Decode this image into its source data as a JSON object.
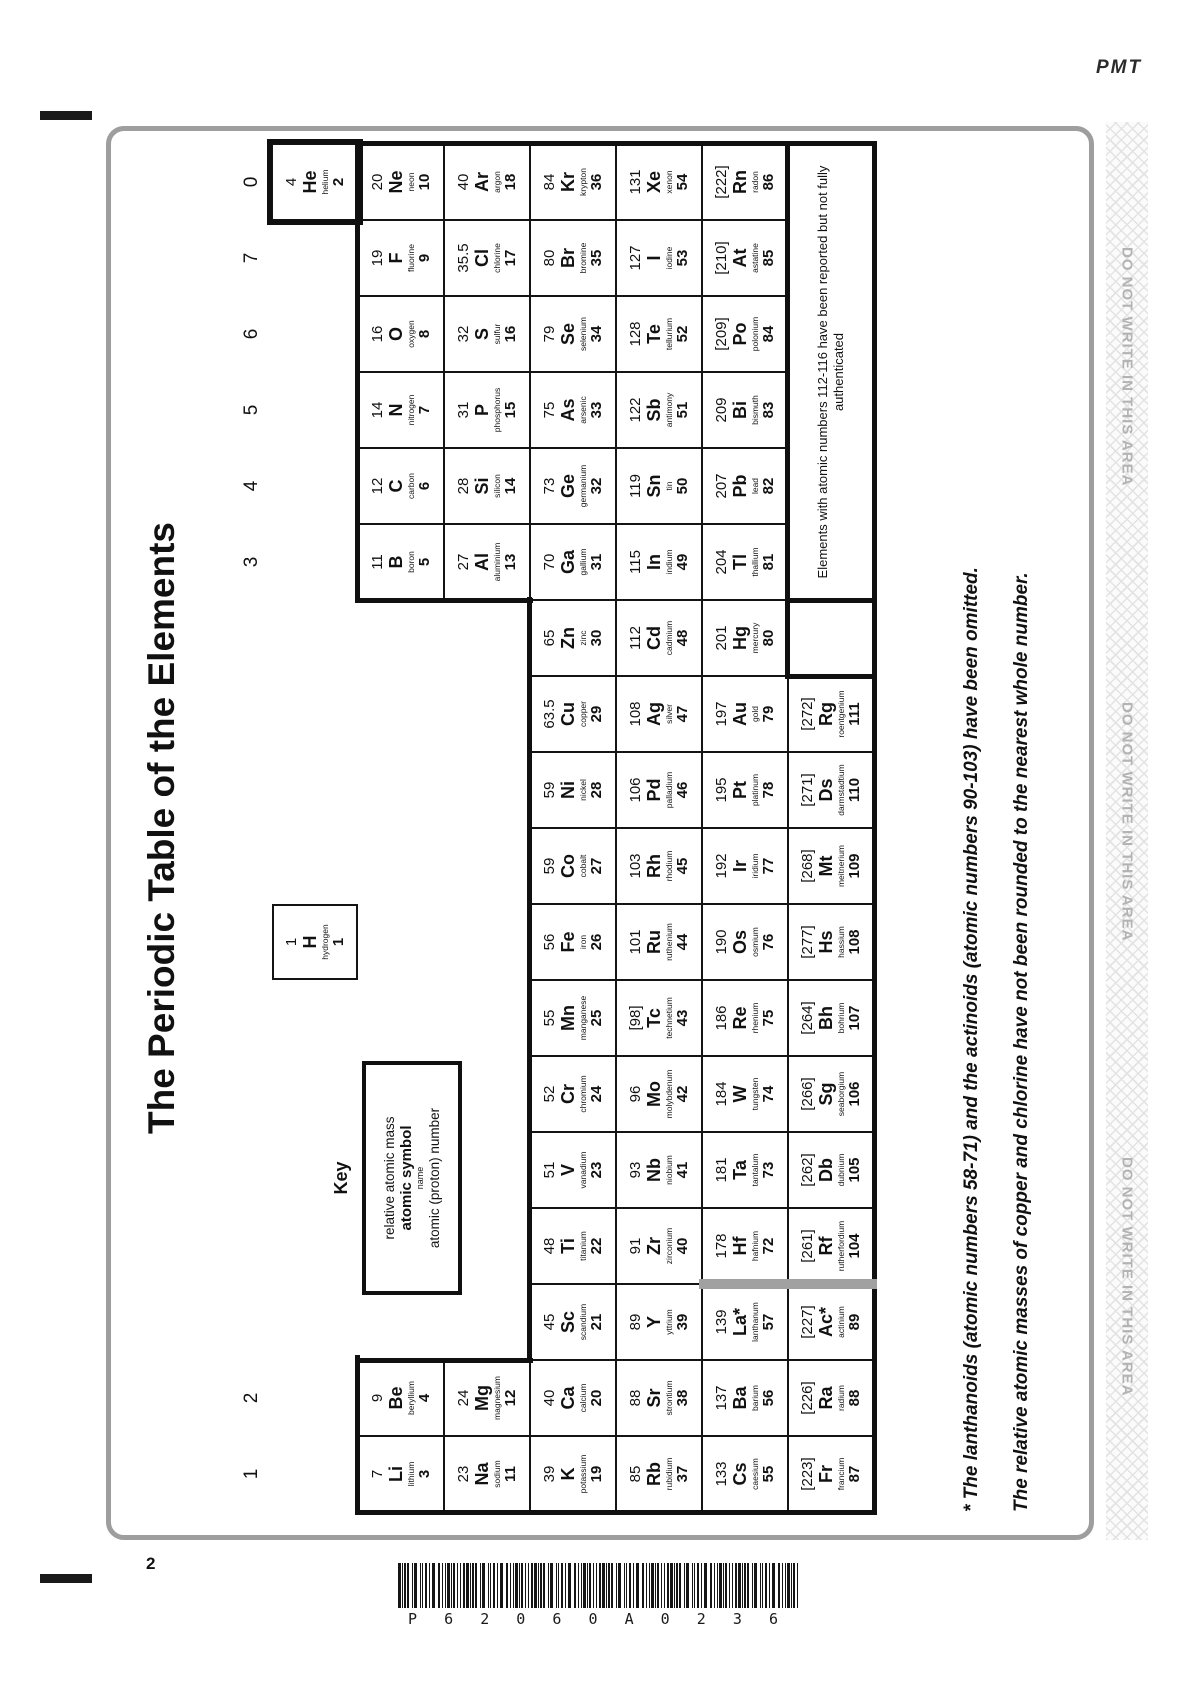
{
  "page": {
    "pmt": "PMT",
    "page_number": "2",
    "barcode_text": "P62060A0236"
  },
  "margin_strip": {
    "text": "DO NOT WRITE IN THIS AREA",
    "repeat": 3
  },
  "colors": {
    "frame_gray": "#9e9e9e",
    "strip_text_gray": "#b3b3b3",
    "divider_gray": "#a1a1a1",
    "ink": "#111111"
  },
  "table": {
    "title": "The Periodic Table of the Elements",
    "group_labels": [
      {
        "label": "1",
        "col": 1
      },
      {
        "label": "2",
        "col": 2
      },
      {
        "label": "3",
        "col": 13
      },
      {
        "label": "4",
        "col": 14
      },
      {
        "label": "5",
        "col": 15
      },
      {
        "label": "6",
        "col": 16
      },
      {
        "label": "7",
        "col": 17
      },
      {
        "label": "0",
        "col": 18
      }
    ],
    "key": {
      "heading": "Key",
      "mass": "relative atomic mass",
      "symbol": "atomic symbol",
      "name": "name",
      "number": "atomic (proton) number"
    },
    "note_lines": [
      "Elements with atomic numbers 112-116 have been reported but not fully",
      "authenticated"
    ],
    "footnotes": [
      "* The lanthanoids (atomic numbers 58-71) and the actinoids (atomic numbers 90-103) have been omitted.",
      "The relative atomic masses of copper and chlorine have not been rounded to the nearest whole number."
    ],
    "elements": [
      {
        "m": "1",
        "s": "H",
        "n": "hydrogen",
        "z": "1",
        "r": 1,
        "c": 8
      },
      {
        "m": "4",
        "s": "He",
        "n": "helium",
        "z": "2",
        "r": 1,
        "c": 18
      },
      {
        "m": "7",
        "s": "Li",
        "n": "lithium",
        "z": "3",
        "r": 2,
        "c": 1
      },
      {
        "m": "9",
        "s": "Be",
        "n": "beryllium",
        "z": "4",
        "r": 2,
        "c": 2
      },
      {
        "m": "11",
        "s": "B",
        "n": "boron",
        "z": "5",
        "r": 2,
        "c": 13
      },
      {
        "m": "12",
        "s": "C",
        "n": "carbon",
        "z": "6",
        "r": 2,
        "c": 14
      },
      {
        "m": "14",
        "s": "N",
        "n": "nitrogen",
        "z": "7",
        "r": 2,
        "c": 15
      },
      {
        "m": "16",
        "s": "O",
        "n": "oxygen",
        "z": "8",
        "r": 2,
        "c": 16
      },
      {
        "m": "19",
        "s": "F",
        "n": "fluorine",
        "z": "9",
        "r": 2,
        "c": 17
      },
      {
        "m": "20",
        "s": "Ne",
        "n": "neon",
        "z": "10",
        "r": 2,
        "c": 18
      },
      {
        "m": "23",
        "s": "Na",
        "n": "sodium",
        "z": "11",
        "r": 3,
        "c": 1
      },
      {
        "m": "24",
        "s": "Mg",
        "n": "magnesium",
        "z": "12",
        "r": 3,
        "c": 2
      },
      {
        "m": "27",
        "s": "Al",
        "n": "aluminium",
        "z": "13",
        "r": 3,
        "c": 13
      },
      {
        "m": "28",
        "s": "Si",
        "n": "silicon",
        "z": "14",
        "r": 3,
        "c": 14
      },
      {
        "m": "31",
        "s": "P",
        "n": "phosphorus",
        "z": "15",
        "r": 3,
        "c": 15
      },
      {
        "m": "32",
        "s": "S",
        "n": "sulfur",
        "z": "16",
        "r": 3,
        "c": 16
      },
      {
        "m": "35.5",
        "s": "Cl",
        "n": "chlorine",
        "z": "17",
        "r": 3,
        "c": 17
      },
      {
        "m": "40",
        "s": "Ar",
        "n": "argon",
        "z": "18",
        "r": 3,
        "c": 18
      },
      {
        "m": "39",
        "s": "K",
        "n": "potassium",
        "z": "19",
        "r": 4,
        "c": 1
      },
      {
        "m": "40",
        "s": "Ca",
        "n": "calcium",
        "z": "20",
        "r": 4,
        "c": 2
      },
      {
        "m": "45",
        "s": "Sc",
        "n": "scandium",
        "z": "21",
        "r": 4,
        "c": 3
      },
      {
        "m": "48",
        "s": "Ti",
        "n": "titanium",
        "z": "22",
        "r": 4,
        "c": 4
      },
      {
        "m": "51",
        "s": "V",
        "n": "vanadium",
        "z": "23",
        "r": 4,
        "c": 5
      },
      {
        "m": "52",
        "s": "Cr",
        "n": "chromium",
        "z": "24",
        "r": 4,
        "c": 6
      },
      {
        "m": "55",
        "s": "Mn",
        "n": "manganese",
        "z": "25",
        "r": 4,
        "c": 7
      },
      {
        "m": "56",
        "s": "Fe",
        "n": "iron",
        "z": "26",
        "r": 4,
        "c": 8
      },
      {
        "m": "59",
        "s": "Co",
        "n": "cobalt",
        "z": "27",
        "r": 4,
        "c": 9
      },
      {
        "m": "59",
        "s": "Ni",
        "n": "nickel",
        "z": "28",
        "r": 4,
        "c": 10
      },
      {
        "m": "63.5",
        "s": "Cu",
        "n": "copper",
        "z": "29",
        "r": 4,
        "c": 11
      },
      {
        "m": "65",
        "s": "Zn",
        "n": "zinc",
        "z": "30",
        "r": 4,
        "c": 12
      },
      {
        "m": "70",
        "s": "Ga",
        "n": "gallium",
        "z": "31",
        "r": 4,
        "c": 13
      },
      {
        "m": "73",
        "s": "Ge",
        "n": "germanium",
        "z": "32",
        "r": 4,
        "c": 14
      },
      {
        "m": "75",
        "s": "As",
        "n": "arsenic",
        "z": "33",
        "r": 4,
        "c": 15
      },
      {
        "m": "79",
        "s": "Se",
        "n": "selenium",
        "z": "34",
        "r": 4,
        "c": 16
      },
      {
        "m": "80",
        "s": "Br",
        "n": "bromine",
        "z": "35",
        "r": 4,
        "c": 17
      },
      {
        "m": "84",
        "s": "Kr",
        "n": "krypton",
        "z": "36",
        "r": 4,
        "c": 18
      },
      {
        "m": "85",
        "s": "Rb",
        "n": "rubidium",
        "z": "37",
        "r": 5,
        "c": 1
      },
      {
        "m": "88",
        "s": "Sr",
        "n": "strontium",
        "z": "38",
        "r": 5,
        "c": 2
      },
      {
        "m": "89",
        "s": "Y",
        "n": "yttrium",
        "z": "39",
        "r": 5,
        "c": 3
      },
      {
        "m": "91",
        "s": "Zr",
        "n": "zirconium",
        "z": "40",
        "r": 5,
        "c": 4
      },
      {
        "m": "93",
        "s": "Nb",
        "n": "niobium",
        "z": "41",
        "r": 5,
        "c": 5
      },
      {
        "m": "96",
        "s": "Mo",
        "n": "molybdenum",
        "z": "42",
        "r": 5,
        "c": 6
      },
      {
        "m": "[98]",
        "s": "Tc",
        "n": "technetium",
        "z": "43",
        "r": 5,
        "c": 7
      },
      {
        "m": "101",
        "s": "Ru",
        "n": "ruthenium",
        "z": "44",
        "r": 5,
        "c": 8
      },
      {
        "m": "103",
        "s": "Rh",
        "n": "rhodium",
        "z": "45",
        "r": 5,
        "c": 9
      },
      {
        "m": "106",
        "s": "Pd",
        "n": "palladium",
        "z": "46",
        "r": 5,
        "c": 10
      },
      {
        "m": "108",
        "s": "Ag",
        "n": "silver",
        "z": "47",
        "r": 5,
        "c": 11
      },
      {
        "m": "112",
        "s": "Cd",
        "n": "cadmium",
        "z": "48",
        "r": 5,
        "c": 12
      },
      {
        "m": "115",
        "s": "In",
        "n": "indium",
        "z": "49",
        "r": 5,
        "c": 13
      },
      {
        "m": "119",
        "s": "Sn",
        "n": "tin",
        "z": "50",
        "r": 5,
        "c": 14
      },
      {
        "m": "122",
        "s": "Sb",
        "n": "antimony",
        "z": "51",
        "r": 5,
        "c": 15
      },
      {
        "m": "128",
        "s": "Te",
        "n": "tellurium",
        "z": "52",
        "r": 5,
        "c": 16
      },
      {
        "m": "127",
        "s": "I",
        "n": "iodine",
        "z": "53",
        "r": 5,
        "c": 17
      },
      {
        "m": "131",
        "s": "Xe",
        "n": "xenon",
        "z": "54",
        "r": 5,
        "c": 18
      },
      {
        "m": "133",
        "s": "Cs",
        "n": "caesium",
        "z": "55",
        "r": 6,
        "c": 1
      },
      {
        "m": "137",
        "s": "Ba",
        "n": "barium",
        "z": "56",
        "r": 6,
        "c": 2
      },
      {
        "m": "139",
        "s": "La*",
        "n": "lanthanum",
        "z": "57",
        "r": 6,
        "c": 3
      },
      {
        "m": "178",
        "s": "Hf",
        "n": "hafnium",
        "z": "72",
        "r": 6,
        "c": 4
      },
      {
        "m": "181",
        "s": "Ta",
        "n": "tantalum",
        "z": "73",
        "r": 6,
        "c": 5
      },
      {
        "m": "184",
        "s": "W",
        "n": "tungsten",
        "z": "74",
        "r": 6,
        "c": 6
      },
      {
        "m": "186",
        "s": "Re",
        "n": "rhenium",
        "z": "75",
        "r": 6,
        "c": 7
      },
      {
        "m": "190",
        "s": "Os",
        "n": "osmium",
        "z": "76",
        "r": 6,
        "c": 8
      },
      {
        "m": "192",
        "s": "Ir",
        "n": "iridium",
        "z": "77",
        "r": 6,
        "c": 9
      },
      {
        "m": "195",
        "s": "Pt",
        "n": "platinum",
        "z": "78",
        "r": 6,
        "c": 10
      },
      {
        "m": "197",
        "s": "Au",
        "n": "gold",
        "z": "79",
        "r": 6,
        "c": 11
      },
      {
        "m": "201",
        "s": "Hg",
        "n": "mercury",
        "z": "80",
        "r": 6,
        "c": 12
      },
      {
        "m": "204",
        "s": "Tl",
        "n": "thallium",
        "z": "81",
        "r": 6,
        "c": 13
      },
      {
        "m": "207",
        "s": "Pb",
        "n": "lead",
        "z": "82",
        "r": 6,
        "c": 14
      },
      {
        "m": "209",
        "s": "Bi",
        "n": "bismuth",
        "z": "83",
        "r": 6,
        "c": 15
      },
      {
        "m": "[209]",
        "s": "Po",
        "n": "polonium",
        "z": "84",
        "r": 6,
        "c": 16
      },
      {
        "m": "[210]",
        "s": "At",
        "n": "astatine",
        "z": "85",
        "r": 6,
        "c": 17
      },
      {
        "m": "[222]",
        "s": "Rn",
        "n": "radon",
        "z": "86",
        "r": 6,
        "c": 18
      },
      {
        "m": "[223]",
        "s": "Fr",
        "n": "francium",
        "z": "87",
        "r": 7,
        "c": 1
      },
      {
        "m": "[226]",
        "s": "Ra",
        "n": "radium",
        "z": "88",
        "r": 7,
        "c": 2
      },
      {
        "m": "[227]",
        "s": "Ac*",
        "n": "actinium",
        "z": "89",
        "r": 7,
        "c": 3
      },
      {
        "m": "[261]",
        "s": "Rf",
        "n": "rutherfordium",
        "z": "104",
        "r": 7,
        "c": 4
      },
      {
        "m": "[262]",
        "s": "Db",
        "n": "dubnium",
        "z": "105",
        "r": 7,
        "c": 5
      },
      {
        "m": "[266]",
        "s": "Sg",
        "n": "seaborgium",
        "z": "106",
        "r": 7,
        "c": 6
      },
      {
        "m": "[264]",
        "s": "Bh",
        "n": "bohrium",
        "z": "107",
        "r": 7,
        "c": 7
      },
      {
        "m": "[277]",
        "s": "Hs",
        "n": "hassium",
        "z": "108",
        "r": 7,
        "c": 8
      },
      {
        "m": "[268]",
        "s": "Mt",
        "n": "meitnerium",
        "z": "109",
        "r": 7,
        "c": 9
      },
      {
        "m": "[271]",
        "s": "Ds",
        "n": "darmstadtium",
        "z": "110",
        "r": 7,
        "c": 10
      },
      {
        "m": "[272]",
        "s": "Rg",
        "n": "roentgenium",
        "z": "111",
        "r": 7,
        "c": 11
      }
    ]
  }
}
